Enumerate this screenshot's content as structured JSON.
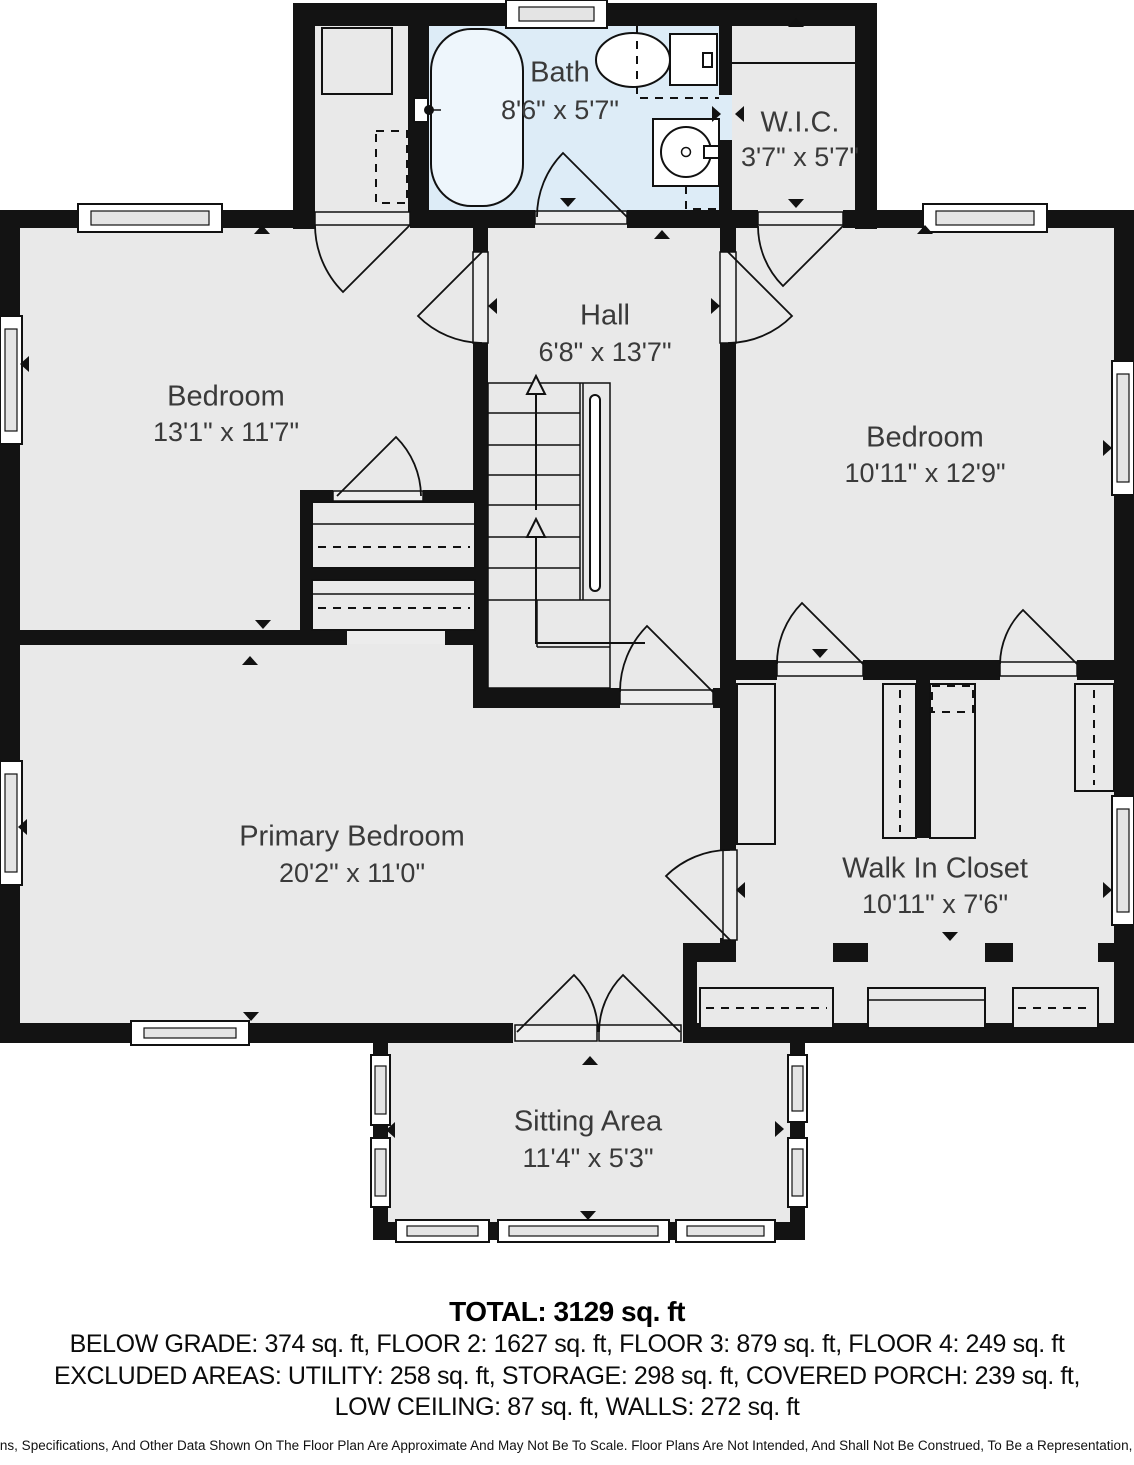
{
  "plan": {
    "rooms": [
      {
        "name": "Bath",
        "dims": "8'6\" x 5'7\""
      },
      {
        "name": "W.I.C.",
        "dims": "3'7\" x 5'7\""
      },
      {
        "name": "Hall",
        "dims": "6'8\" x 13'7\""
      },
      {
        "name": "Bedroom",
        "dims": "13'1\" x 11'7\""
      },
      {
        "name": "Bedroom",
        "dims": "10'11\" x 12'9\""
      },
      {
        "name": "Primary Bedroom",
        "dims": "20'2\" x 11'0\""
      },
      {
        "name": "Walk In Closet",
        "dims": "10'11\" x 7'6\""
      },
      {
        "name": "Sitting Area",
        "dims": "11'4\" x 5'3\""
      }
    ],
    "fixtures": [
      "bathtub",
      "toilet",
      "sink-vanity",
      "staircase",
      "closet-shelves"
    ]
  },
  "footer": {
    "total": "TOTAL: 3129 sq. ft",
    "floors": "BELOW GRADE: 374 sq. ft, FLOOR 2: 1627 sq. ft, FLOOR 3: 879 sq. ft, FLOOR 4: 249 sq. ft",
    "excluded": "EXCLUDED AREAS: UTILITY: 258 sq. ft, STORAGE: 298 sq. ft, COVERED PORCH: 239 sq. ft,",
    "excluded2": "LOW CEILING: 87 sq. ft, WALLS: 272 sq. ft",
    "disclaimer": "Dimensions, Specifications, And Other Data Shown On The Floor Plan Are Approximate And May Not Be To Scale. Floor Plans Are Not Intended, And Shall Not Be Construed, To Be a Representation, Warranty"
  },
  "colors": {
    "wall": "#131313",
    "floor": "#e9e9e9",
    "bath": "#ddecf7",
    "label": "#3a3a3a"
  }
}
